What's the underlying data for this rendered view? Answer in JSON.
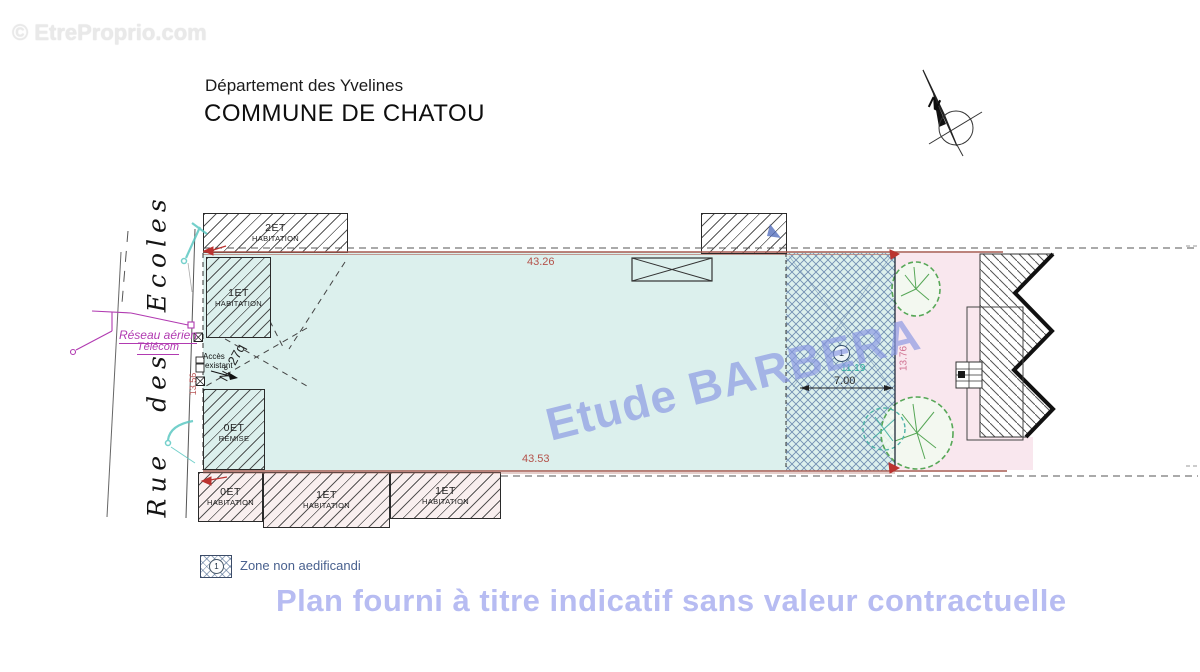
{
  "watermarks": {
    "site": "© EtreProprio.com",
    "studio": "Etude BARBERA",
    "disclaimer": "Plan fourni à titre indicatif sans valeur contractuelle"
  },
  "header": {
    "department": "Département des Yvelines",
    "commune": "COMMUNE DE CHATOU"
  },
  "street_name": "Rue des Ecoles",
  "north_letter": "N",
  "annotations": {
    "network_line1": "Réseau aérien",
    "network_line2": "Télécom",
    "access_line1": "Accès",
    "access_line2": "existant",
    "parcel_ref": "N° 27q"
  },
  "buildings": {
    "top_main": {
      "floors": "2ET",
      "use": "HABITATION"
    },
    "left_house": {
      "floors": "1ET",
      "use": "HABITATION"
    },
    "shed": {
      "floors": "0ET",
      "use": "REMISE"
    },
    "south_1": {
      "floors": "0ET",
      "use": "HABITATION"
    },
    "south_2": {
      "floors": "1ET",
      "use": "HABITATION"
    },
    "south_3": {
      "floors": "1ET",
      "use": "HABITATION"
    }
  },
  "dimensions": {
    "north_side": "43.26",
    "south_side": "43.53",
    "west_side": "13.56",
    "east_side": "13.76",
    "zone_width": "7.00",
    "zone_depth": "11.19"
  },
  "zone_marker": "1",
  "legend": {
    "marker": "1",
    "label": "Zone non aedificandi"
  },
  "colors": {
    "parcel_cyan": "#dcf0ed",
    "zone_pink": "#f9e7ee",
    "boundary_red": "#a55a50",
    "telecom_magenta": "#b13ab1",
    "utility_teal": "#5cc8c3",
    "dimension_red": "#b4524a",
    "watermark_blue": "#8b99e3",
    "disclaimer_blue": "#b7bcf2"
  }
}
